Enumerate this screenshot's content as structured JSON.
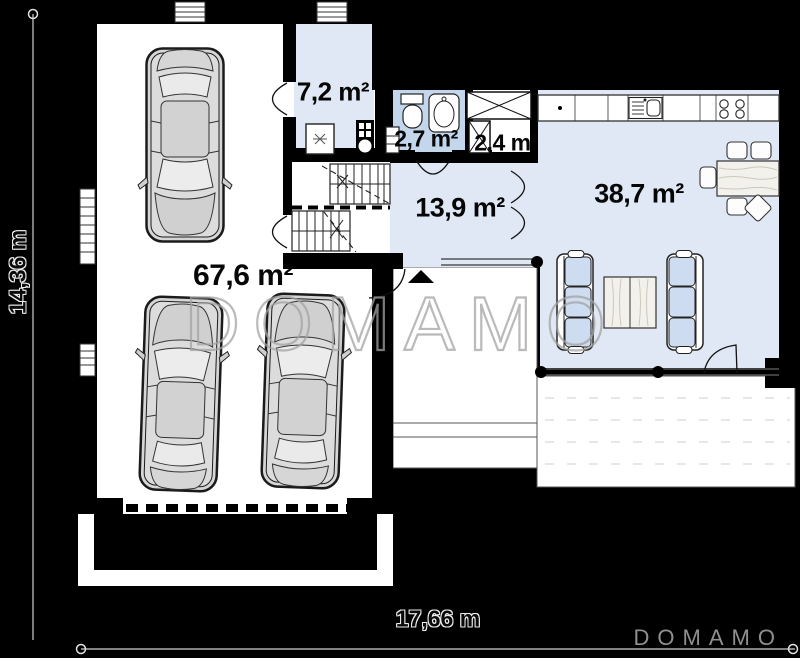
{
  "plan": {
    "dimensions": {
      "height": "14,36 m",
      "width": "17,66 m"
    },
    "rooms": {
      "garage": "67,6 m²",
      "utility": "7,2 m²",
      "bathroom": "2,7 m²",
      "wardrobe": "2,4 m²",
      "hall": "13,9 m²",
      "living_kitchen": "38,7 m²"
    },
    "watermark": {
      "center": "DOMAMO",
      "corner": "DOMAMO"
    },
    "colors": {
      "background": "#000000",
      "floor": "#ffffff",
      "room_fill": "#dfe8f4",
      "bathroom_fill": "#c3d6ec",
      "furniture_fill": "#cddcf0",
      "wall": "#000000",
      "watermark": "#a0a0a0"
    }
  }
}
